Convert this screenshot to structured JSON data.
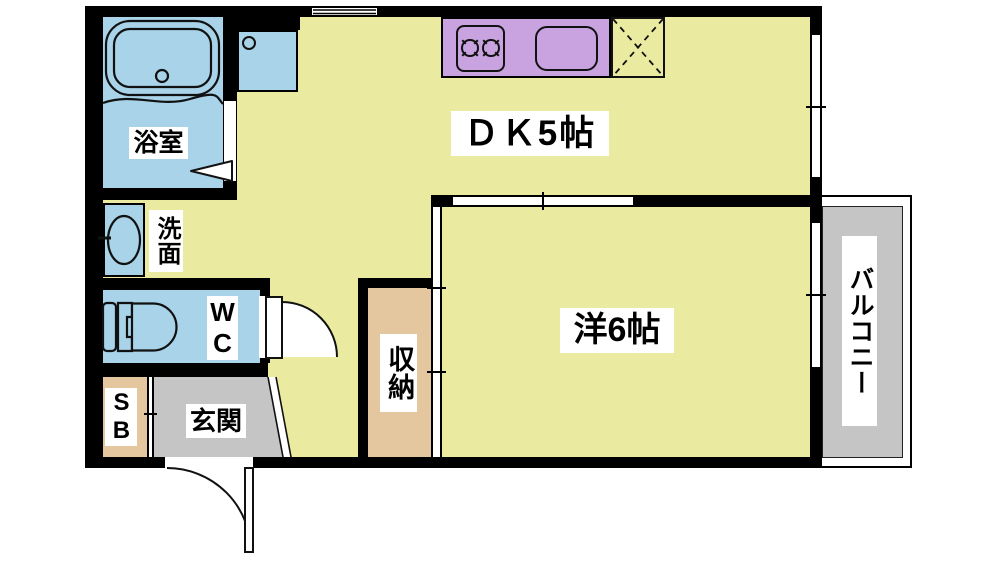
{
  "rooms": {
    "bathroom": {
      "label": "浴室"
    },
    "washroom": {
      "label": "洗面"
    },
    "wc": {
      "label": "WC"
    },
    "shoe_box": {
      "label": "SB"
    },
    "entrance": {
      "label": "玄関"
    },
    "storage": {
      "label": "収納"
    },
    "dining_kitchen": {
      "label": "ＤＫ5帖"
    },
    "western_room": {
      "label": "洋6帖"
    },
    "balcony": {
      "label": "バルコニー"
    }
  },
  "colors": {
    "floor": "#eaeaa0",
    "water": "#a8d3e8",
    "kitchen": "#c9a3e0",
    "wood": "#e4c79f",
    "gray": "#c5c5c5",
    "wall": "#000000",
    "label_bg": "#ffffff",
    "text": "#000000"
  },
  "fixtures": [
    "bathtub",
    "washing-machine-space",
    "washbasin",
    "toilet",
    "kitchen-stove",
    "kitchen-sink",
    "refrigerator-space",
    "bathroom-door",
    "wc-door",
    "entrance-door",
    "sliding-door-room",
    "sliding-door-closet",
    "window-top",
    "window-dk",
    "window-room",
    "balcony"
  ]
}
